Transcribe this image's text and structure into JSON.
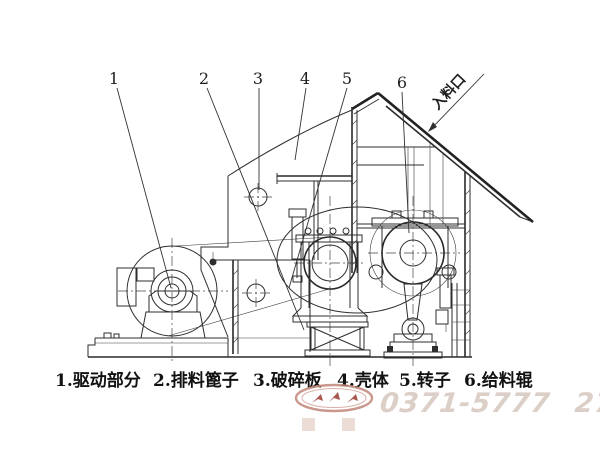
{
  "figure": {
    "type": "technical-diagram",
    "subject": "crusher machine side-view line drawing",
    "callouts": [
      "1",
      "2",
      "3",
      "4",
      "5",
      "6"
    ],
    "inlet_label": "入料口"
  },
  "caption": {
    "items": [
      "1.驱动部分",
      "2.排料篦子",
      "3.破碎板",
      "4.壳体",
      "5.转子",
      "6.给料辊"
    ]
  },
  "watermark": {
    "phone": "0371-5777 2727",
    "logo": "oval-arrows-logo"
  },
  "colors": {
    "ink": "#2e2e2e",
    "background": "#ffffff",
    "watermark_red": "#c1867a",
    "phone_gray": "#dccfc8"
  }
}
